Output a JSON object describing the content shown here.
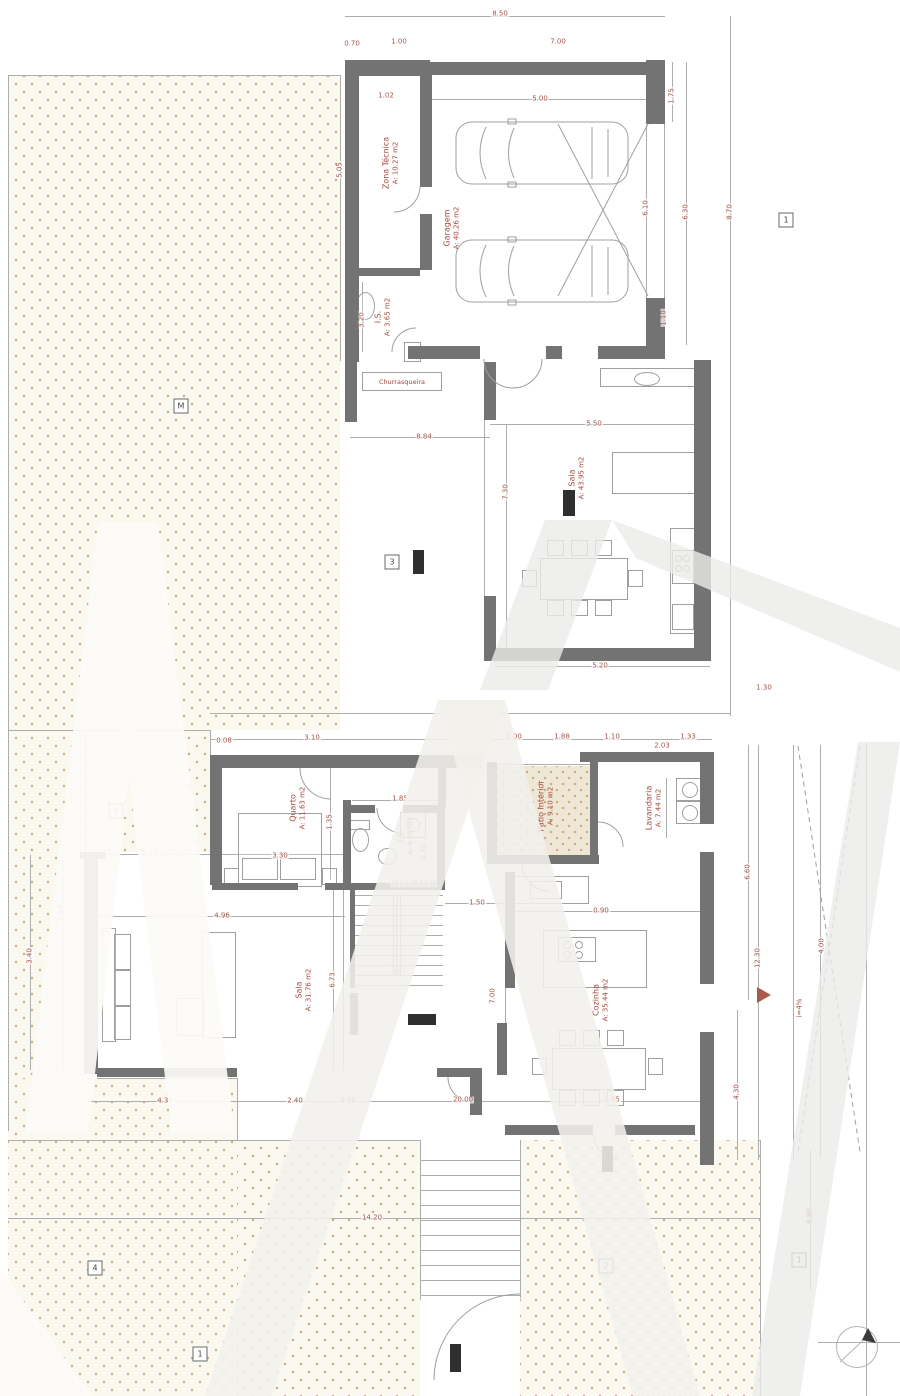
{
  "plan": {
    "rooms": {
      "zona_tecnica": {
        "name": "Zona Técnica",
        "area": "A: 10.27 m2"
      },
      "garagem": {
        "name": "Garagem",
        "area": "A: 40.26 m2"
      },
      "is_upper": {
        "name": "I.S.",
        "area": "A: 3.65 m2"
      },
      "churrasqueira": {
        "name": "Churrasqueira",
        "area": ""
      },
      "sala_upper": {
        "name": "Sala",
        "area": "A: 43.95 m2"
      },
      "quarto": {
        "name": "Quarto",
        "area": "A: 11.63 m2"
      },
      "is_lower": {
        "name": "I.S.",
        "area": "A: 4.35 m2"
      },
      "patio": {
        "name": "Pátio interior",
        "area": "A: 9.10 m2"
      },
      "lavandaria": {
        "name": "Lavandaria",
        "area": "A: 7.44 m2"
      },
      "cozinha": {
        "name": "Cozinha",
        "area": "A: 35.44 m2"
      },
      "sala_lower": {
        "name": "Sala",
        "area": "A: 31.76 m2"
      }
    },
    "stairs_formula": "18 x 0.18 x 0.25",
    "slope_label": "i=4%",
    "dimensions": [
      {
        "t": "8.50",
        "x": 500,
        "y": 14
      },
      {
        "t": "0.70",
        "x": 352,
        "y": 44
      },
      {
        "t": "1.00",
        "x": 399,
        "y": 42
      },
      {
        "t": "7.00",
        "x": 558,
        "y": 42
      },
      {
        "t": "5.00",
        "x": 540,
        "y": 99
      },
      {
        "t": "1.02",
        "x": 386,
        "y": 96
      },
      {
        "t": "5.05",
        "x": 340,
        "y": 170,
        "v": 1
      },
      {
        "t": "3.20",
        "x": 362,
        "y": 320,
        "v": 1
      },
      {
        "t": "6.10",
        "x": 646,
        "y": 208,
        "v": 1
      },
      {
        "t": "1.75",
        "x": 672,
        "y": 96,
        "v": 1
      },
      {
        "t": "6.30",
        "x": 686,
        "y": 212,
        "v": 1
      },
      {
        "t": "8.70",
        "x": 730,
        "y": 212,
        "v": 1
      },
      {
        "t": "1.10",
        "x": 664,
        "y": 318,
        "v": 1
      },
      {
        "t": "8.84",
        "x": 424,
        "y": 437
      },
      {
        "t": "5.50",
        "x": 594,
        "y": 424
      },
      {
        "t": "7.30",
        "x": 506,
        "y": 492,
        "v": 1
      },
      {
        "t": "5.20",
        "x": 600,
        "y": 666
      },
      {
        "t": "14.00",
        "x": 468,
        "y": 713
      },
      {
        "t": "1.30",
        "x": 764,
        "y": 688
      },
      {
        "t": "0.08",
        "x": 224,
        "y": 741
      },
      {
        "t": "3.10",
        "x": 312,
        "y": 738
      },
      {
        "t": "1.00",
        "x": 468,
        "y": 737
      },
      {
        "t": "2.00",
        "x": 514,
        "y": 737
      },
      {
        "t": "1.88",
        "x": 562,
        "y": 737
      },
      {
        "t": "1.10",
        "x": 612,
        "y": 737
      },
      {
        "t": "1.33",
        "x": 688,
        "y": 737
      },
      {
        "t": "2.03",
        "x": 662,
        "y": 746
      },
      {
        "t": "3.15",
        "x": 150,
        "y": 854
      },
      {
        "t": "3.30",
        "x": 280,
        "y": 856
      },
      {
        "t": "1.35",
        "x": 330,
        "y": 822,
        "v": 1
      },
      {
        "t": "1.85",
        "x": 400,
        "y": 799
      },
      {
        "t": "0.35",
        "x": 424,
        "y": 852,
        "v": 1
      },
      {
        "t": "1.50",
        "x": 477,
        "y": 903
      },
      {
        "t": "4.96",
        "x": 222,
        "y": 916
      },
      {
        "t": "6.73",
        "x": 333,
        "y": 980,
        "v": 1
      },
      {
        "t": "1.80",
        "x": 62,
        "y": 913,
        "v": 1
      },
      {
        "t": "3.40",
        "x": 30,
        "y": 956,
        "v": 1
      },
      {
        "t": "0.90",
        "x": 601,
        "y": 911
      },
      {
        "t": "7.00",
        "x": 493,
        "y": 996,
        "v": 1
      },
      {
        "t": "6.60",
        "x": 748,
        "y": 872,
        "v": 1
      },
      {
        "t": "12.30",
        "x": 758,
        "y": 958,
        "v": 1
      },
      {
        "t": "4.00",
        "x": 822,
        "y": 946,
        "v": 1
      },
      {
        "t": "4.30",
        "x": 737,
        "y": 1092,
        "v": 1
      },
      {
        "t": "4.30",
        "x": 165,
        "y": 1101
      },
      {
        "t": "2.40",
        "x": 295,
        "y": 1101
      },
      {
        "t": "0.60",
        "x": 348,
        "y": 1101
      },
      {
        "t": "20.00",
        "x": 463,
        "y": 1100
      },
      {
        "t": "2.85",
        "x": 612,
        "y": 1100
      },
      {
        "t": "14.20",
        "x": 372,
        "y": 1218
      },
      {
        "t": "6.80",
        "x": 810,
        "y": 1216,
        "v": 1
      }
    ],
    "badges": [
      {
        "t": "M",
        "x": 181,
        "y": 406
      },
      {
        "t": "3",
        "x": 392,
        "y": 562
      },
      {
        "t": "5",
        "x": 116,
        "y": 811
      },
      {
        "t": "1",
        "x": 786,
        "y": 220
      },
      {
        "t": "2",
        "x": 606,
        "y": 1266
      },
      {
        "t": "1",
        "x": 799,
        "y": 1260
      },
      {
        "t": "4",
        "x": 95,
        "y": 1268
      },
      {
        "t": "1",
        "x": 200,
        "y": 1354
      }
    ]
  }
}
